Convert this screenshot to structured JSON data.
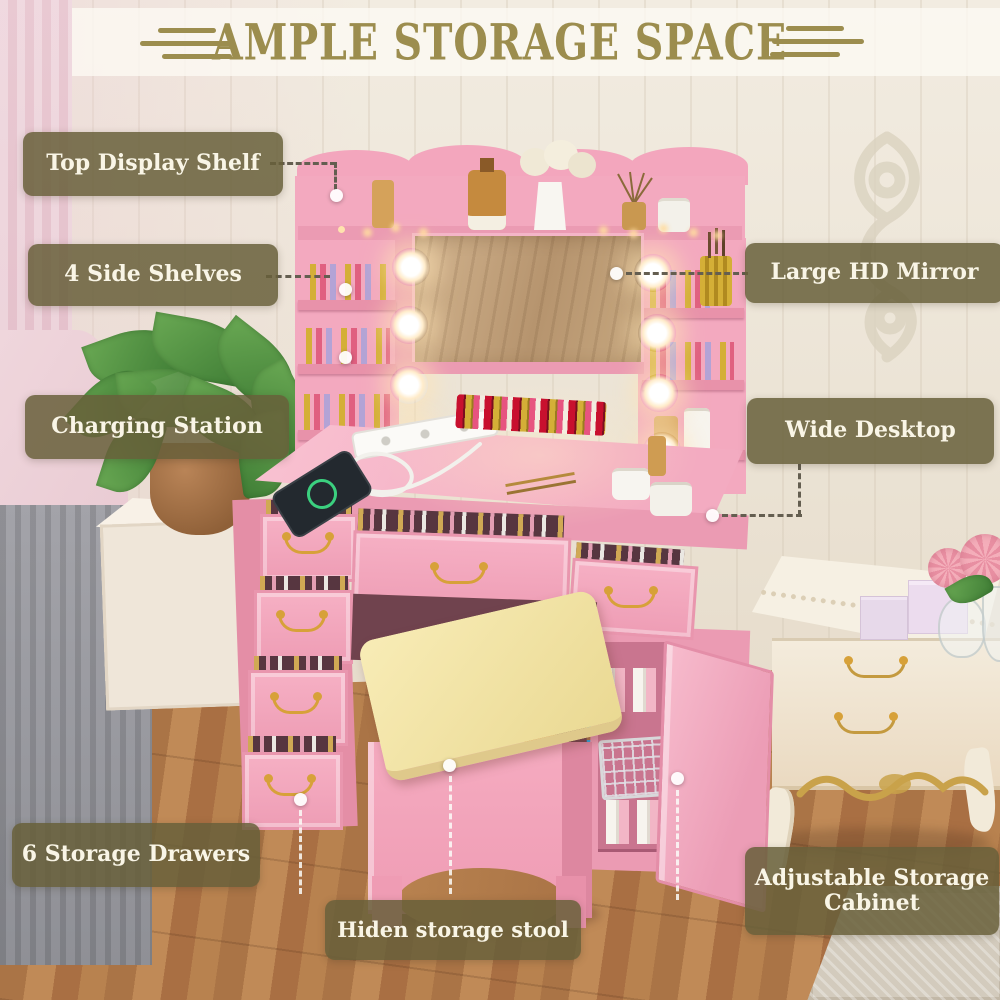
{
  "title": "AMPLE STORAGE SPACE",
  "callouts": [
    {
      "id": "top-display-shelf",
      "label": "Top Display Shelf"
    },
    {
      "id": "side-shelves",
      "label": "4 Side Shelves"
    },
    {
      "id": "charging-station",
      "label": "Charging Station"
    },
    {
      "id": "large-hd-mirror",
      "label": "Large HD Mirror"
    },
    {
      "id": "wide-desktop",
      "label": "Wide Desktop"
    },
    {
      "id": "storage-drawers",
      "label": "6 Storage Drawers"
    },
    {
      "id": "adjustable-storage-cabinet",
      "label": "Adjustable Storage Cabinet"
    },
    {
      "id": "hidden-storage-stool",
      "label": "Hiden storage stool"
    }
  ],
  "colors": {
    "accent_olive": "#9c8d4e",
    "pill_background": "rgba(103,95,58,0.85)",
    "pill_text": "#f9f5e6",
    "furniture_pink": "#f3a9bf",
    "cushion_yellow": "#f2e2a4",
    "adjust_arrow_blue": "#26a9e6",
    "wood_floor": "#b8824f"
  }
}
